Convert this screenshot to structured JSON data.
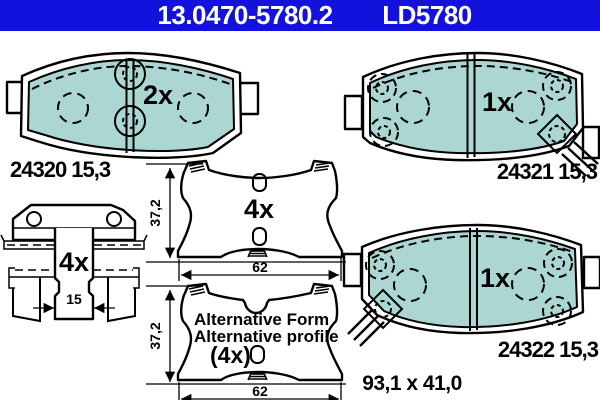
{
  "colors": {
    "header_bar": "#1312dc",
    "header_text": "#ffffff",
    "pad_friction_fill": "#abd6d2",
    "line": "#000000",
    "background": "#ffffff"
  },
  "header": {
    "part_number": "13.0470-5780.2",
    "trade_number": "LD5780"
  },
  "drawings": {
    "pad_24320": {
      "quantity": "2x",
      "label": "24320 15,3"
    },
    "pad_24321": {
      "quantity": "1x",
      "label": "24321 15,3"
    },
    "pad_24322": {
      "quantity": "1x",
      "label": "24322 15,3",
      "overall_size": "93,1 x 41,0"
    },
    "hardware_kit": {
      "quantity": "4x",
      "width_mm": "15"
    },
    "backplate": {
      "quantity": "4x",
      "height_mm": "37,2",
      "width_mm": "62"
    },
    "backplate_alternative": {
      "note_line1": "Alternative Form",
      "note_line2": "Alternative profile",
      "quantity": "(4x)",
      "height_mm": "37,2",
      "width_mm": "62"
    }
  }
}
